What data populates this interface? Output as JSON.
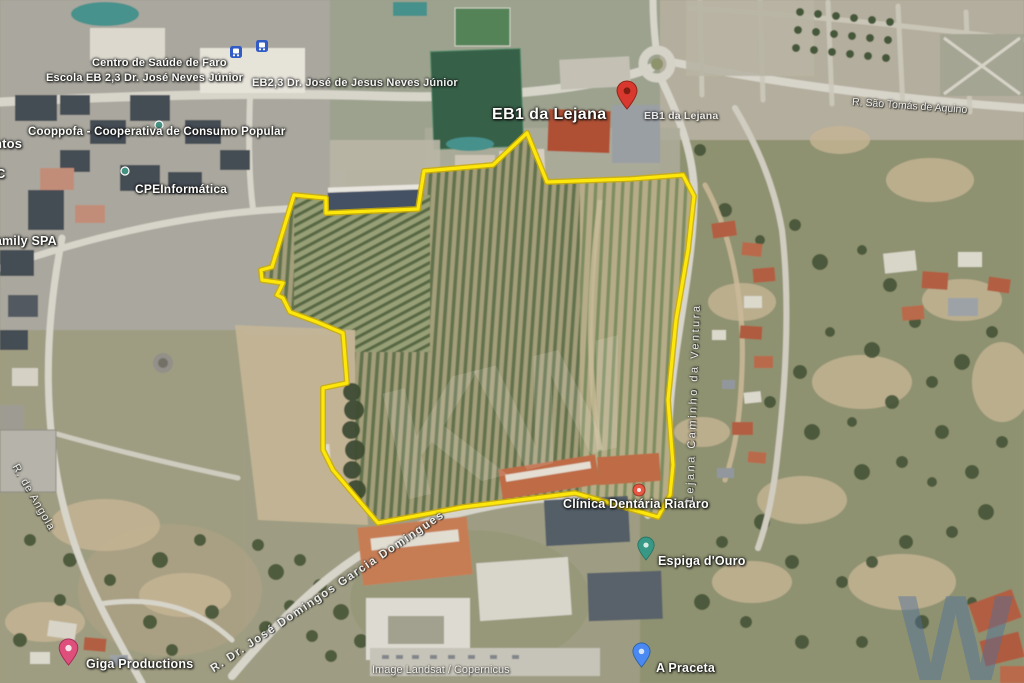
{
  "map": {
    "attribution": "Image Landsat / Copernicus",
    "boundary": {
      "color": "#ffe800",
      "casing": "#c9a900"
    },
    "watermark": {
      "center": "KW",
      "corner": "W"
    },
    "labels": {
      "centro_saude": "Centro de Saúde de Faro",
      "escola_eb23": "Escola EB 2,3 Dr. José Neves Júnior",
      "eb23_jesus": "EB2,3 Dr. José de Jesus Neves Júnior",
      "cooppofa": "Cooppofa - Cooperativa de Consumo Popular",
      "fragment_ntos": "ntos",
      "fragment_c": "C",
      "cpe_informatica": "CPEInformática",
      "family_spa": "Family SPA",
      "eb1_main": "EB1 da Lejana",
      "eb1_small": "EB1 da Lejana",
      "giga": "Giga Productions",
      "clinica": "Clínica Dentária Riafaro",
      "espiga": "Espiga d'Ouro",
      "praceta": "A Praceta"
    },
    "streets": {
      "sao_tomas": "R. São Tomás de Aquino",
      "angola": "R. de Angola",
      "ventura": "Lejana Caminho da Ventura",
      "garcia_domingues": "R. Dr. José Domingos Garcia Domingues"
    },
    "pins": {
      "eb1": {
        "color": "#d93025"
      },
      "giga": {
        "color": "#df4878"
      },
      "espiga": {
        "color": "#2f9582"
      },
      "praceta": {
        "color": "#4285f4"
      },
      "clinica": {
        "color": "#e8513d"
      },
      "poi_dot": {
        "color": "#3e8e7e"
      },
      "transit": {
        "color": "#2a56c6"
      }
    }
  }
}
